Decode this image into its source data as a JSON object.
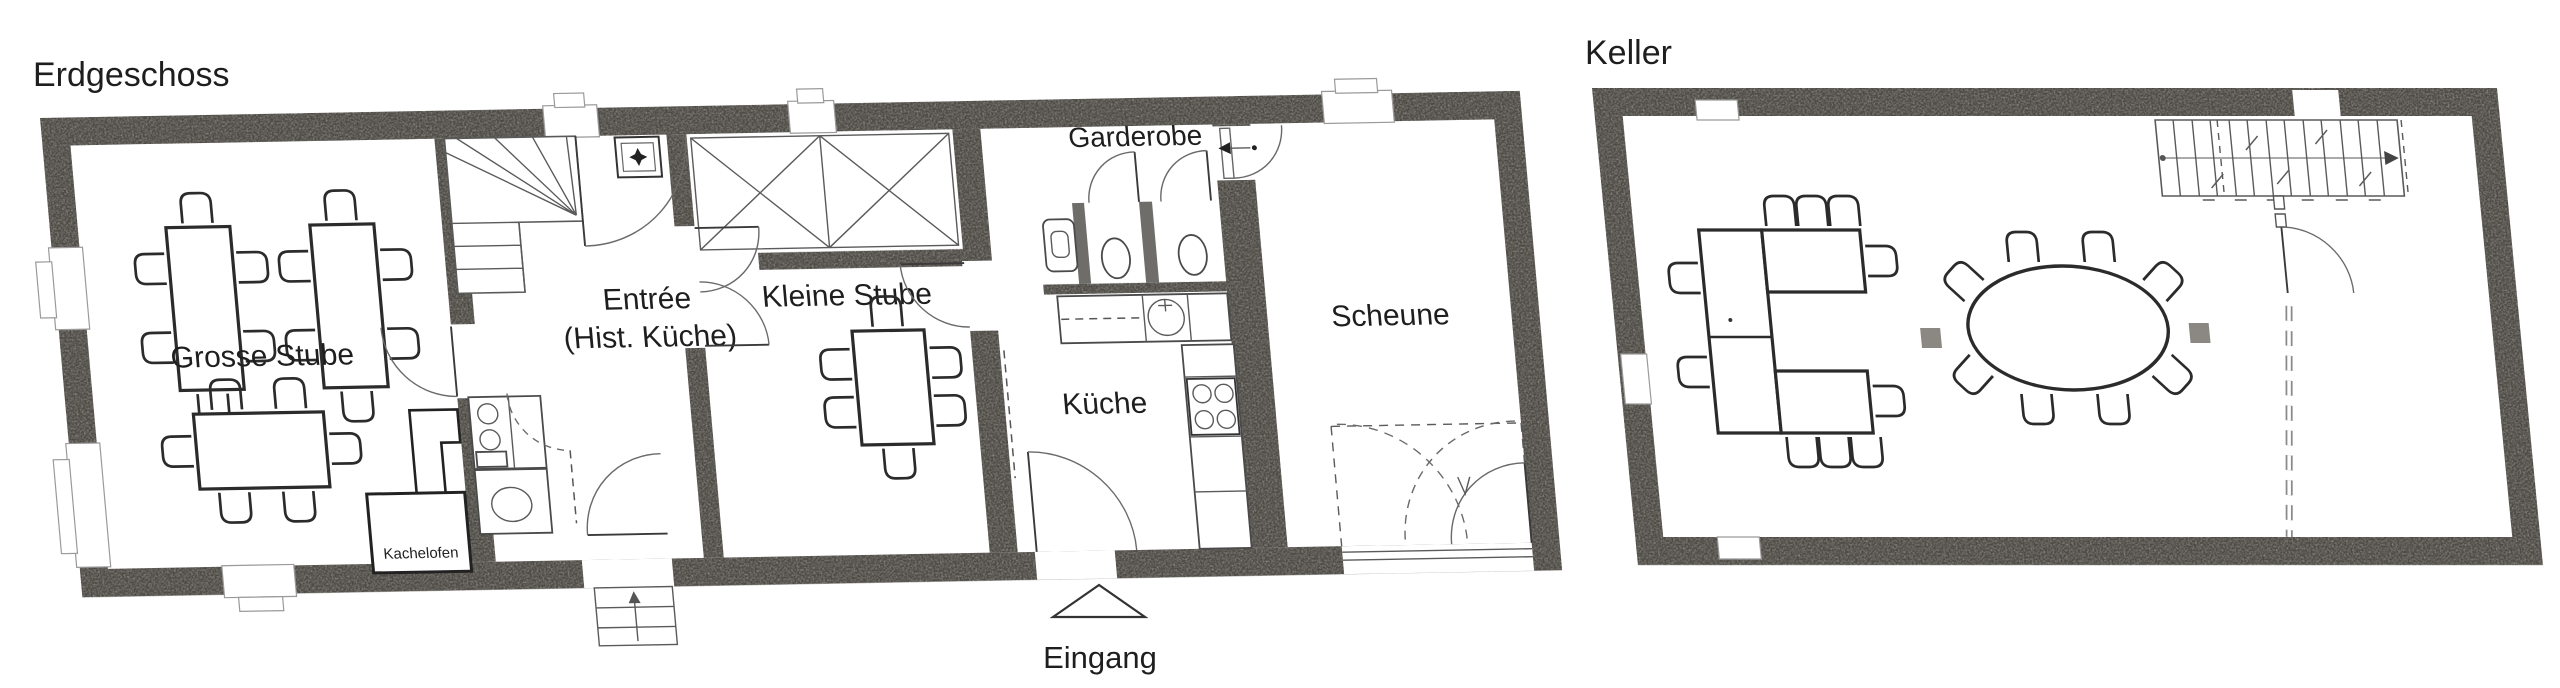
{
  "figure": {
    "background": "#ffffff",
    "wall_color": "#908d88",
    "line_color": "#2b2b2b",
    "plans": [
      {
        "title": "Erdgeschoss",
        "rooms": [
          {
            "label": "Grosse Stube"
          },
          {
            "label": "Entrée",
            "label2": "(Hist. Küche)"
          },
          {
            "label": "Kleine Stube"
          },
          {
            "label": "Garderobe"
          },
          {
            "label": "Küche"
          },
          {
            "label": "Scheune"
          }
        ],
        "annotations": [
          {
            "label": "Kachelofen"
          },
          {
            "label": "Eingang"
          }
        ]
      },
      {
        "title": "Keller",
        "rooms": [],
        "annotations": []
      }
    ]
  }
}
